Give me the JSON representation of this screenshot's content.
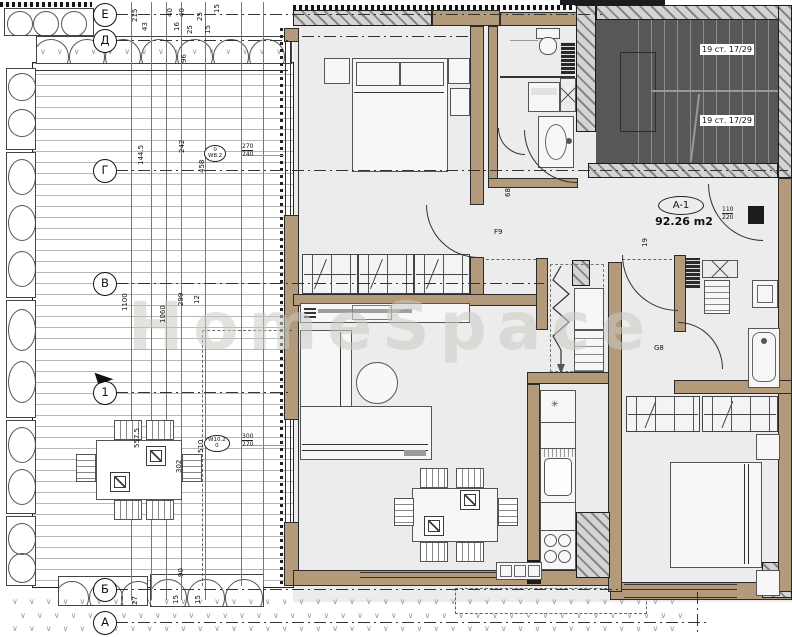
{
  "watermark": "HomeSpace",
  "apartment": {
    "tag": "A-1",
    "area": "92.26 m2"
  },
  "stairs": {
    "labels": [
      "19 ст. 17/29",
      "19 ст. 17/29"
    ]
  },
  "grid": {
    "items": [
      "Е",
      "Д",
      "Г",
      "В",
      "1",
      "Б",
      "А"
    ]
  },
  "window_tags": [
    {
      "line1": "0",
      "line2": "W8.2",
      "dim_top": "270",
      "dim_bottom": "240"
    },
    {
      "line1": "W10.2",
      "line2": "0",
      "dim_top": "300",
      "dim_bottom": "270"
    }
  ],
  "door_tag": {
    "width": "110",
    "height": "220"
  },
  "dim_labels": [
    {
      "t": "215",
      "x": 132,
      "y": 22,
      "r": 1
    },
    {
      "t": "43",
      "x": 142,
      "y": 31,
      "r": 1
    },
    {
      "t": "40",
      "x": 167,
      "y": 17,
      "r": 1
    },
    {
      "t": "40",
      "x": 179,
      "y": 17,
      "r": 1
    },
    {
      "t": "16",
      "x": 174,
      "y": 31,
      "r": 1
    },
    {
      "t": "25",
      "x": 187,
      "y": 34,
      "r": 1
    },
    {
      "t": "25",
      "x": 197,
      "y": 21,
      "r": 1
    },
    {
      "t": "15",
      "x": 205,
      "y": 34,
      "r": 1
    },
    {
      "t": "15",
      "x": 214,
      "y": 13,
      "r": 1
    },
    {
      "t": "96",
      "x": 181,
      "y": 63,
      "r": 1
    },
    {
      "t": "242",
      "x": 179,
      "y": 153,
      "r": 1
    },
    {
      "t": "144.5",
      "x": 138,
      "y": 165,
      "r": 1
    },
    {
      "t": "458",
      "x": 199,
      "y": 173,
      "r": 1
    },
    {
      "t": "1100",
      "x": 122,
      "y": 311,
      "r": 1
    },
    {
      "t": "1060",
      "x": 160,
      "y": 323,
      "r": 1
    },
    {
      "t": "299",
      "x": 178,
      "y": 306,
      "r": 1
    },
    {
      "t": "12",
      "x": 194,
      "y": 304,
      "r": 1
    },
    {
      "t": "557.5",
      "x": 134,
      "y": 448,
      "r": 1
    },
    {
      "t": "302",
      "x": 176,
      "y": 473,
      "r": 1
    },
    {
      "t": "510",
      "x": 198,
      "y": 453,
      "r": 1
    },
    {
      "t": "90",
      "x": 178,
      "y": 577,
      "r": 1
    },
    {
      "t": "27",
      "x": 132,
      "y": 605,
      "r": 1
    },
    {
      "t": "15",
      "x": 173,
      "y": 604,
      "r": 1
    },
    {
      "t": "15",
      "x": 195,
      "y": 604,
      "r": 1
    },
    {
      "t": "68",
      "x": 505,
      "y": 197,
      "r": 1
    },
    {
      "t": "19",
      "x": 642,
      "y": 247,
      "r": 1
    },
    {
      "t": "F9",
      "x": 494,
      "y": 229,
      "r": 0
    },
    {
      "t": "G8",
      "x": 654,
      "y": 345,
      "r": 0
    }
  ],
  "decor": {
    "v_row": "∨∨∨∨∨∨∨∨∨∨∨∨∨∨∨∨∨∨∨∨∨∨∨∨∨∨∨∨∨∨∨∨∨∨∨∨∨∨∨∨",
    "star": "✳"
  }
}
